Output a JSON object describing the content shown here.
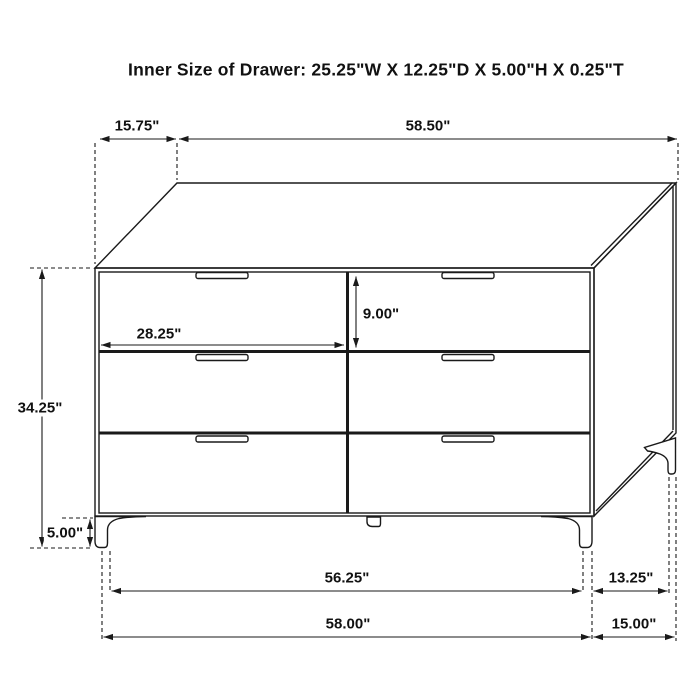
{
  "title": "Inner Size of Drawer: 25.25\"W X 12.25\"D X 5.00\"H X 0.25\"T",
  "diagram": {
    "type": "furniture-dimension-drawing",
    "item": "6-drawer dresser, front-right perspective line drawing",
    "colors": {
      "line": "#1a1a1a",
      "background": "#ffffff"
    },
    "drawer_count": 6,
    "dimensions": {
      "top_depth": "15.75\"",
      "top_width": "58.50\"",
      "drawer_opening_height": "9.00\"",
      "drawer_width": "28.25\"",
      "body_height": "34.25\"",
      "leg_height": "5.00\"",
      "front_leg_span": "56.25\"",
      "side_leg_span": "13.25\"",
      "overall_width": "58.00\"",
      "overall_depth": "15.00\""
    }
  }
}
